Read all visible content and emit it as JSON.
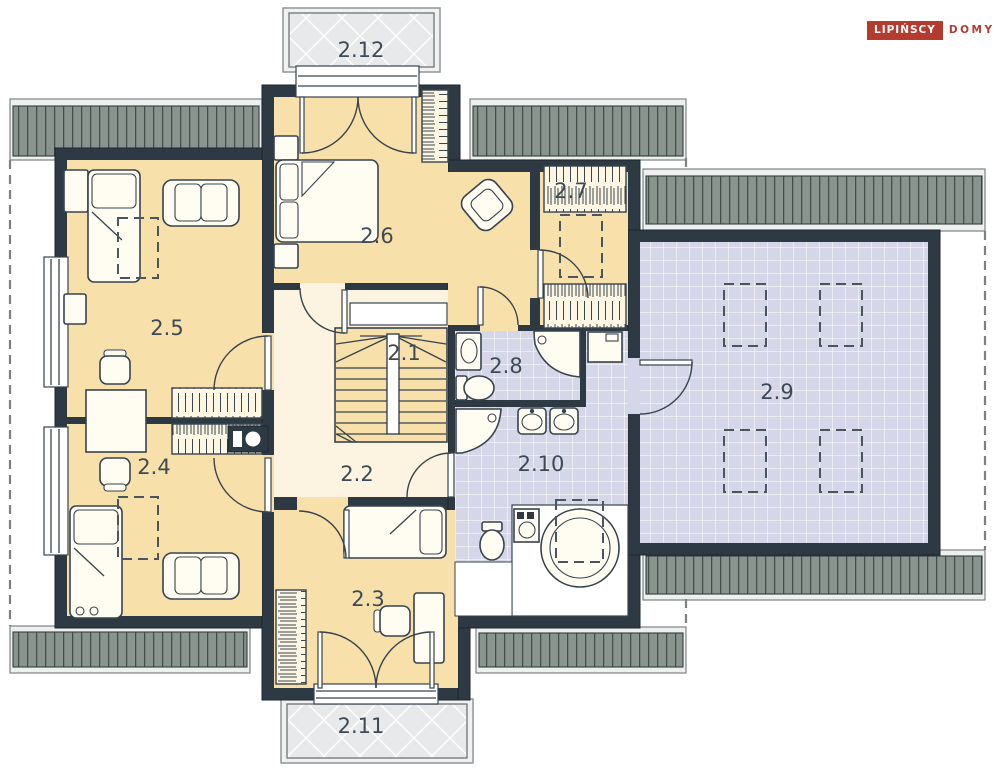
{
  "brand": {
    "primary": "LIPIŃSCY",
    "secondary": "DOMY"
  },
  "rooms": {
    "r2_1": "2.1",
    "r2_2": "2.2",
    "r2_3": "2.3",
    "r2_4": "2.4",
    "r2_5": "2.5",
    "r2_6": "2.6",
    "r2_7": "2.7",
    "r2_8": "2.8",
    "r2_9": "2.9",
    "r2_10": "2.10",
    "r2_11": "2.11",
    "r2_12": "2.12"
  },
  "colors": {
    "wall": "#2d3a43",
    "bedroom_floor": "#f8e0aa",
    "hall_floor": "#fcf4e0",
    "bath_floor": "#d5d7e8",
    "balcony_floor": "#e8e9ea",
    "roof_hatch": "#8a948e",
    "brand_red": "#b43b2e",
    "label_text": "#3d4a55"
  }
}
